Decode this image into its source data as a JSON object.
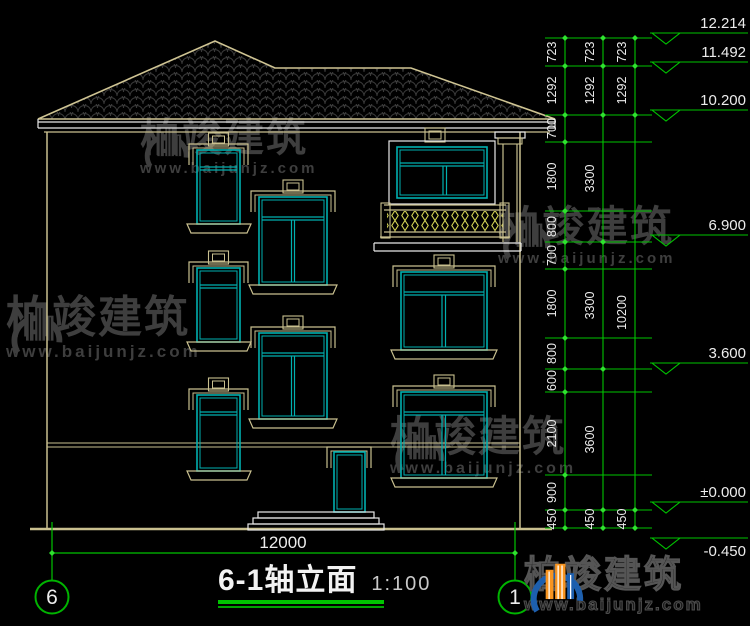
{
  "brand": {
    "name": "柏竣建筑",
    "url": "www.baijunjz.com"
  },
  "title": {
    "text": "6-1轴立面",
    "scale": "1:100"
  },
  "axes": {
    "left": "6",
    "right": "1"
  },
  "dims": {
    "bottom": "12000",
    "inner": [
      "723",
      "1292",
      "700",
      "1800",
      "800",
      "700",
      "1800",
      "800",
      "600",
      "2100",
      "900",
      "450"
    ],
    "mid": [
      "723",
      "1292",
      "3300",
      "3300",
      "3600",
      "450"
    ],
    "outer": [
      "723",
      "1292",
      "10200",
      "450"
    ],
    "levels": [
      "12.214",
      "11.492",
      "10.200",
      "6.900",
      "3.600",
      "±0.000",
      "-0.450"
    ]
  },
  "colors": {
    "dim_green": "#00c400",
    "tick_green": "#2ee22e",
    "wall_tan": "#c9c08f",
    "window_cyan": "#00b0b0",
    "railing_yellow": "#d4d455",
    "text_white": "#ececec",
    "watermark_gray": "#3e3e3e",
    "logo_blue": "#1d5fae",
    "logo_orange": "#f79420"
  }
}
